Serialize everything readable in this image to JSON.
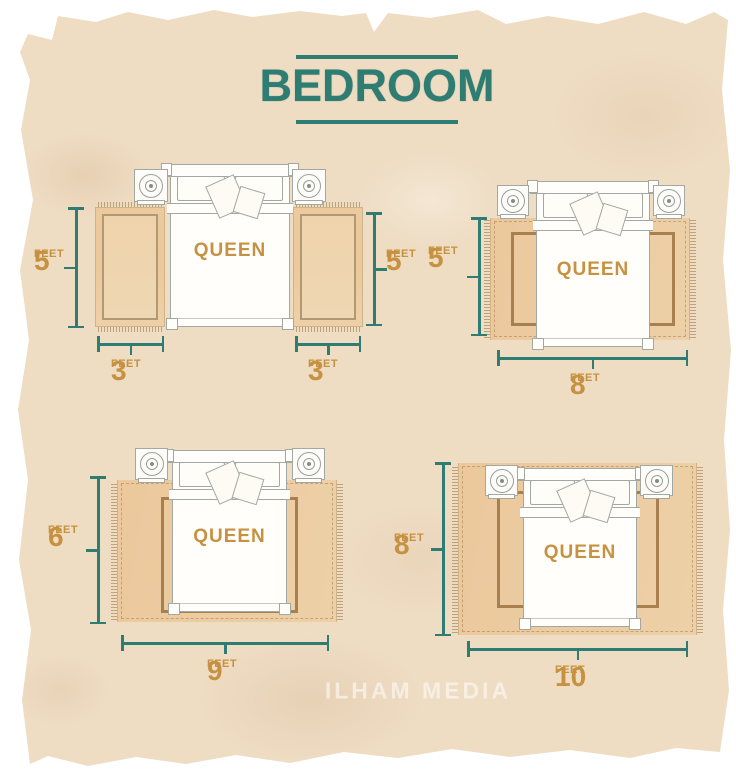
{
  "title": "BEDROOM",
  "watermark": "ILHAM MEDIA",
  "colors": {
    "teal": "#2f7c72",
    "gold": "#c69140",
    "paper": "#eedcc3",
    "rug": "#ebc69d",
    "rug_border": "#a8804f"
  },
  "diagrams": [
    {
      "name": "queen-with-side-runners",
      "bed_label": "QUEEN",
      "dimensions": [
        {
          "side": "left",
          "value": "5",
          "unit": "FEET"
        },
        {
          "side": "right",
          "value": "5",
          "unit": "FEET"
        },
        {
          "side": "bottom-left",
          "value": "3",
          "unit": "FEET"
        },
        {
          "side": "bottom-right",
          "value": "3",
          "unit": "FEET"
        }
      ]
    },
    {
      "name": "queen-on-5x8-rug",
      "bed_label": "QUEEN",
      "dimensions": [
        {
          "side": "left",
          "value": "5",
          "unit": "FEET"
        },
        {
          "side": "bottom",
          "value": "8",
          "unit": "FEET"
        }
      ]
    },
    {
      "name": "queen-on-6x9-rug",
      "bed_label": "QUEEN",
      "dimensions": [
        {
          "side": "left",
          "value": "6",
          "unit": "FEET"
        },
        {
          "side": "bottom",
          "value": "9",
          "unit": "FEET"
        }
      ]
    },
    {
      "name": "queen-on-8x10-rug",
      "bed_label": "QUEEN",
      "dimensions": [
        {
          "side": "left",
          "value": "8",
          "unit": "FEET"
        },
        {
          "side": "bottom",
          "value": "10",
          "unit": "FEET"
        }
      ]
    }
  ]
}
